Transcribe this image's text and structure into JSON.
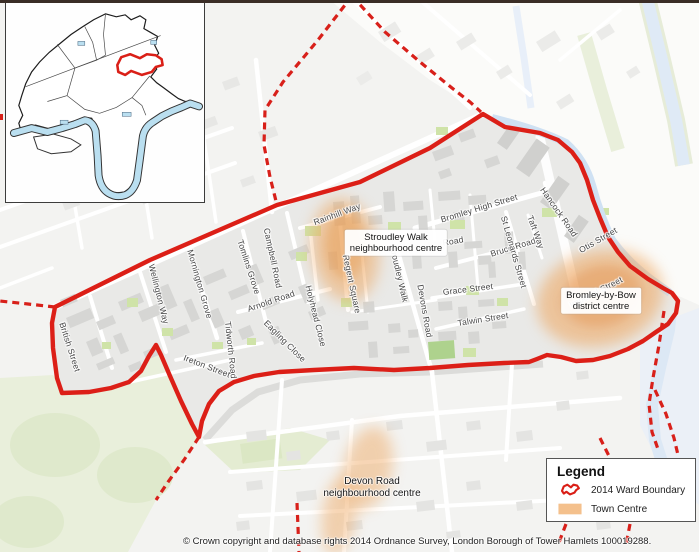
{
  "map": {
    "copyright": "© Crown copyright and database rights 2014 Ordnance Survey, London Borough of Tower Hamlets 100019288.",
    "street_labels": [
      {
        "text": "Rainhill Way",
        "x": 337,
        "y": 214,
        "rot": -20
      },
      {
        "text": "Bromley High Street",
        "x": 479,
        "y": 208,
        "rot": -17
      },
      {
        "text": "Road",
        "x": 453,
        "y": 241,
        "rot": -10
      },
      {
        "text": "Bruce Road",
        "x": 513,
        "y": 247,
        "rot": -17
      },
      {
        "text": "Grace Street",
        "x": 468,
        "y": 289,
        "rot": -7
      },
      {
        "text": "Talwin Street",
        "x": 483,
        "y": 319,
        "rot": -9
      },
      {
        "text": "St Leonards Street",
        "x": 514,
        "y": 252,
        "rot": 74
      },
      {
        "text": "Taft Way",
        "x": 536,
        "y": 232,
        "rot": 70
      },
      {
        "text": "Hancock Road",
        "x": 559,
        "y": 212,
        "rot": 55
      },
      {
        "text": "Otis Street",
        "x": 598,
        "y": 240,
        "rot": -30
      },
      {
        "text": "Imperial Street",
        "x": 596,
        "y": 292,
        "rot": -27
      },
      {
        "text": "Devons Road",
        "x": 425,
        "y": 311,
        "rot": 80
      },
      {
        "text": "Stroudley Walk",
        "x": 399,
        "y": 273,
        "rot": 77
      },
      {
        "text": "Regent Square",
        "x": 352,
        "y": 284,
        "rot": 78
      },
      {
        "text": "Campbell Road",
        "x": 273,
        "y": 258,
        "rot": 78
      },
      {
        "text": "Tomlins Grove",
        "x": 249,
        "y": 267,
        "rot": 72
      },
      {
        "text": "Mornington Grove",
        "x": 200,
        "y": 284,
        "rot": 74
      },
      {
        "text": "Wellington Way",
        "x": 159,
        "y": 294,
        "rot": 76
      },
      {
        "text": "British Street",
        "x": 70,
        "y": 347,
        "rot": 72
      },
      {
        "text": "Tidworth Road",
        "x": 231,
        "y": 350,
        "rot": 84
      },
      {
        "text": "Arnold Road",
        "x": 271,
        "y": 301,
        "rot": -19
      },
      {
        "text": "Holyhead Close",
        "x": 316,
        "y": 316,
        "rot": 76
      },
      {
        "text": "Eagling Close",
        "x": 285,
        "y": 341,
        "rot": 45
      },
      {
        "text": "Ireton Street",
        "x": 207,
        "y": 366,
        "rot": 21
      }
    ],
    "centre_labels": [
      {
        "line1": "Stroudley Walk",
        "line2": "neighbourhood centre",
        "x": 396,
        "y": 243,
        "boxed": true
      },
      {
        "line1": "Bromley-by-Bow",
        "line2": "district centre",
        "x": 601,
        "y": 301,
        "boxed": true
      },
      {
        "line1": "Devon Road",
        "line2": "neighbourhood centre",
        "x": 372,
        "y": 488,
        "boxed": false
      }
    ]
  },
  "legend": {
    "title": "Legend",
    "items": [
      {
        "label": "2014 Ward Boundary",
        "symbol": "ward-boundary-icon"
      },
      {
        "label": "Town Centre",
        "symbol": "town-centre-swatch"
      }
    ]
  },
  "colors": {
    "boundary_red": "#dc1f17",
    "town_centre_orange": "#eea45c",
    "water_blue": "#cfe1f3",
    "park_green": "#e9efdb"
  }
}
